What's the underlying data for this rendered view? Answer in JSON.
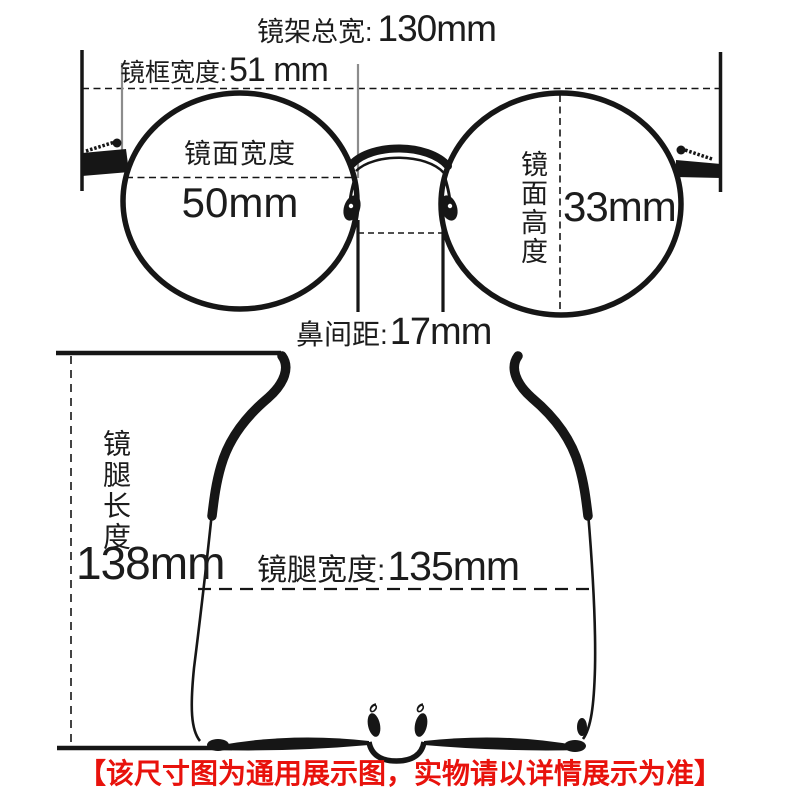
{
  "colors": {
    "background": "#ffffff",
    "ink": "#1c1c1c",
    "line_gray": "#8c8c8c",
    "accent_red": "#e8120c"
  },
  "front_view": {
    "total_width_label": "镜架总宽:",
    "total_width_value": "130mm",
    "frame_width_label": "镜框宽度:",
    "frame_width_value": "51 mm",
    "lens_width_label": "镜面宽度",
    "lens_width_value": "50mm",
    "lens_height_label": "镜面高度",
    "lens_height_value": "33mm",
    "nose_distance_label": "鼻间距:",
    "nose_distance_value": "17mm"
  },
  "top_view": {
    "temple_length_label": "镜腿长度",
    "temple_length_value": "138mm",
    "temple_width_label": "镜腿宽度:",
    "temple_width_value": "135mm"
  },
  "footer": {
    "disclaimer": "【该尺寸图为通用展示图，实物请以详情展示为准】"
  }
}
